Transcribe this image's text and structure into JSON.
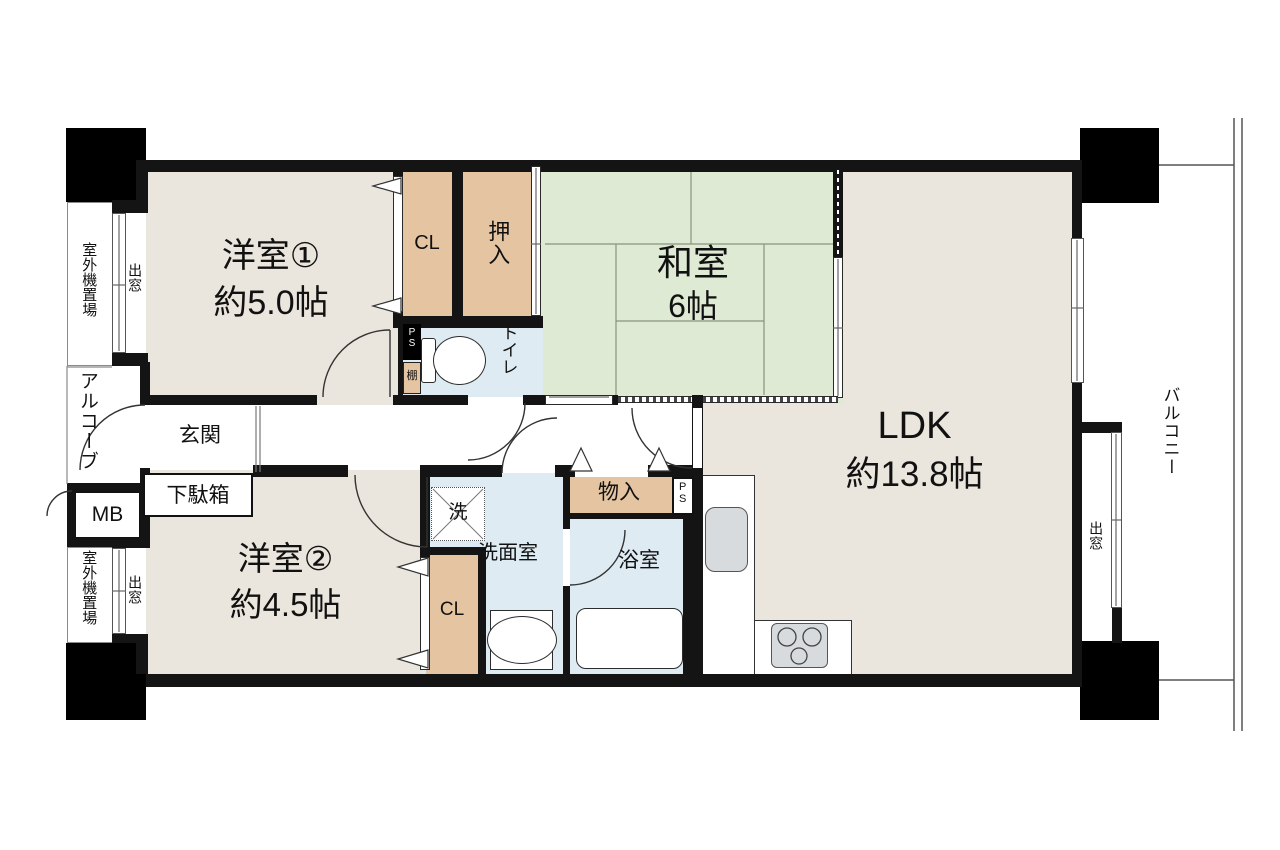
{
  "figure": "apartment-floor-plan",
  "colors": {
    "wall": "#141414",
    "western_room_beige": "#EBE6DD",
    "tatami_green": "#DFEAD4",
    "closet_tan": "#E4C4A1",
    "wet_area_blue": "#DEEBF3",
    "fixture_gray": "#D8DBDD"
  },
  "rooms": {
    "yoshitsu1": {
      "name": "洋室①",
      "size": "約5.0帖"
    },
    "washitsu": {
      "name": "和室",
      "size": "6帖"
    },
    "ldk": {
      "name": "LDK",
      "size": "約13.8帖"
    },
    "yoshitsu2": {
      "name": "洋室②",
      "size": "約4.5帖"
    }
  },
  "areas": {
    "genkan": "玄関",
    "getabako": "下駄箱",
    "alcove": "アルコーブ",
    "meter_box": "MB",
    "outdoor_unit_top": "室外機置場",
    "outdoor_unit_bottom": "室外機置場",
    "bay_window_left_top": "出窓",
    "bay_window_left_bottom": "出窓",
    "bay_window_right": "出窓",
    "balcony": "バルコニー",
    "toilet": "トイレ",
    "senmenshitsu": "洗面室",
    "bathroom": "浴室",
    "monoire": "物入",
    "washer": "洗",
    "closet1": "CL",
    "closet2": "CL",
    "oshiire": "押入",
    "shelf": "棚",
    "pipe_space_top": "PS",
    "pipe_space_bottom": "PS"
  }
}
